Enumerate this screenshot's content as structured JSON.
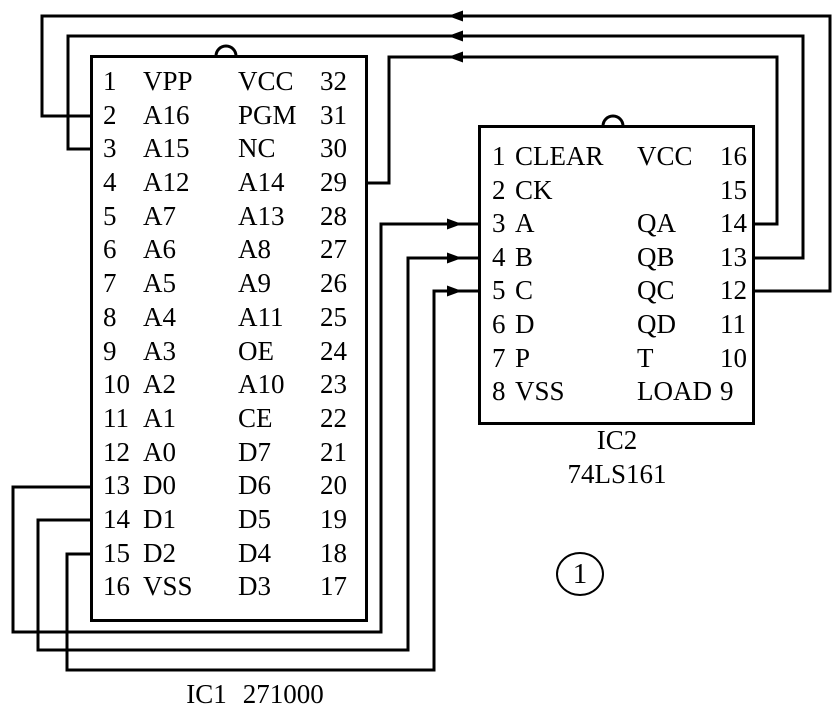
{
  "figure": {
    "number": "1"
  },
  "colors": {
    "ink": "#000000",
    "background": "#ffffff"
  },
  "chips": {
    "ic1": {
      "name": "IC1",
      "part": "271000",
      "rows": [
        {
          "ln": "1",
          "lname": "VPP",
          "rname": "VCC",
          "rn": "32"
        },
        {
          "ln": "2",
          "lname": "A16",
          "rname": "PGM",
          "rn": "31"
        },
        {
          "ln": "3",
          "lname": "A15",
          "rname": "NC",
          "rn": "30"
        },
        {
          "ln": "4",
          "lname": "A12",
          "rname": "A14",
          "rn": "29"
        },
        {
          "ln": "5",
          "lname": "A7",
          "rname": "A13",
          "rn": "28"
        },
        {
          "ln": "6",
          "lname": "A6",
          "rname": "A8",
          "rn": "27"
        },
        {
          "ln": "7",
          "lname": "A5",
          "rname": "A9",
          "rn": "26"
        },
        {
          "ln": "8",
          "lname": "A4",
          "rname": "A11",
          "rn": "25"
        },
        {
          "ln": "9",
          "lname": "A3",
          "rname": "OE",
          "rn": "24"
        },
        {
          "ln": "10",
          "lname": "A2",
          "rname": "A10",
          "rn": "23"
        },
        {
          "ln": "11",
          "lname": "A1",
          "rname": "CE",
          "rn": "22"
        },
        {
          "ln": "12",
          "lname": "A0",
          "rname": "D7",
          "rn": "21"
        },
        {
          "ln": "13",
          "lname": "D0",
          "rname": "D6",
          "rn": "20"
        },
        {
          "ln": "14",
          "lname": "D1",
          "rname": "D5",
          "rn": "19"
        },
        {
          "ln": "15",
          "lname": "D2",
          "rname": "D4",
          "rn": "18"
        },
        {
          "ln": "16",
          "lname": "VSS",
          "rname": "D3",
          "rn": "17"
        }
      ]
    },
    "ic2": {
      "name": "IC2",
      "part": "74LS161",
      "rows": [
        {
          "ln": "1",
          "lname": "CLEAR",
          "rname": "VCC",
          "rn": "16"
        },
        {
          "ln": "2",
          "lname": "CK",
          "rname": "",
          "rn": "15"
        },
        {
          "ln": "3",
          "lname": "A",
          "rname": "QA",
          "rn": "14"
        },
        {
          "ln": "4",
          "lname": "B",
          "rname": "QB",
          "rn": "13"
        },
        {
          "ln": "5",
          "lname": "C",
          "rname": "QC",
          "rn": "12"
        },
        {
          "ln": "6",
          "lname": "D",
          "rname": "QD",
          "rn": "11"
        },
        {
          "ln": "7",
          "lname": "P",
          "rname": "T",
          "rn": "10"
        },
        {
          "ln": "8",
          "lname": "VSS",
          "rname": "LOAD",
          "rn": "9"
        }
      ]
    }
  },
  "nets": [
    {
      "from": "IC2 pin 12 QC",
      "to": "IC1 pin 2 A16",
      "arrow": "left"
    },
    {
      "from": "IC2 pin 13 QB",
      "to": "IC1 pin 3 A15",
      "arrow": "left"
    },
    {
      "from": "IC2 pin 14 QA",
      "to": "IC1 pin 29 A14",
      "arrow": "left"
    },
    {
      "from": "IC1 pin 13 D0",
      "to": "IC2 pin 3 A",
      "arrow": "right"
    },
    {
      "from": "IC1 pin 14 D1",
      "to": "IC2 pin 4 B",
      "arrow": "right"
    },
    {
      "from": "IC1 pin 15 D2",
      "to": "IC2 pin 5 C",
      "arrow": "right"
    }
  ]
}
